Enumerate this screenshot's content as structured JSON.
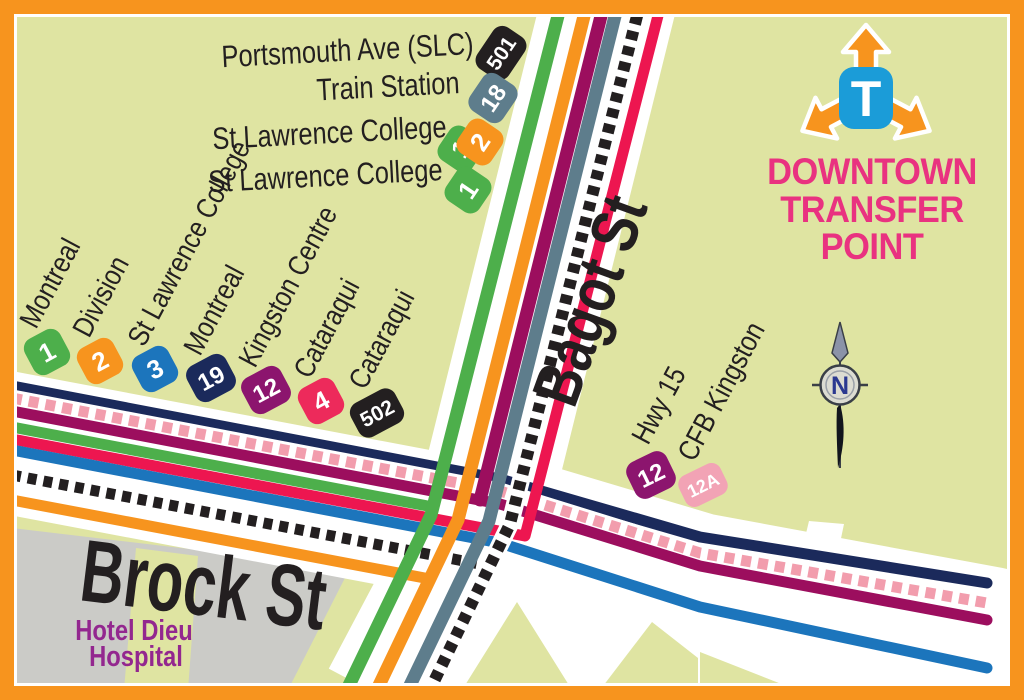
{
  "map_title": {
    "line1": "DOWNTOWN",
    "line2": "TRANSFER",
    "line3": "POINT",
    "logo_letter": "T"
  },
  "streets": {
    "vertical": "Bagot St",
    "horizontal": "Brock St"
  },
  "landmark": {
    "line1": "Hotel Dieu",
    "line2": "Hospital"
  },
  "compass": {
    "north_label": "N"
  },
  "colors": {
    "border": "#F7941E",
    "background": "#DFE4A2",
    "road": "#FFFFFF",
    "block_gray": "#CBCBC7",
    "title_pink": "#E93280",
    "landmark_purple": "#93278F",
    "label_black": "#231F20",
    "logo_blue": "#1B9CD8",
    "logo_orange": "#F7941E",
    "compass_navy": "#2B3990"
  },
  "routes": {
    "r1": {
      "number": "1",
      "color": "#4DAF4B"
    },
    "r2": {
      "number": "2",
      "color": "#F7941E"
    },
    "r3": {
      "number": "3",
      "color": "#1C75BC"
    },
    "r4": {
      "number": "4",
      "color": "#ED1650"
    },
    "r12": {
      "number": "12",
      "color": "#9C0E5E"
    },
    "r12a": {
      "number": "12A",
      "color": "#F29DAD"
    },
    "r18": {
      "number": "18",
      "color": "#5E7D8C"
    },
    "r19": {
      "number": "19",
      "color": "#1B2A5B"
    },
    "r501": {
      "number": "501",
      "color": "#231F20"
    },
    "r502": {
      "number": "502",
      "color": "#231F20"
    }
  },
  "top_stops": [
    {
      "label": "Portsmouth Ave (SLC)",
      "badges": [
        {
          "text": "501",
          "color": "#231F20"
        }
      ]
    },
    {
      "label": "Train Station",
      "badges": [
        {
          "text": "18",
          "color": "#5E7D8C"
        }
      ]
    },
    {
      "label": "St Lawrence College",
      "badges": [
        {
          "text": "1",
          "color": "#4DAF4B"
        },
        {
          "text": "2",
          "color": "#F7941E"
        }
      ]
    },
    {
      "label": "St Lawrence College",
      "badges": [
        {
          "text": "1",
          "color": "#4DAF4B"
        }
      ]
    }
  ],
  "west_stops": [
    {
      "label": "Montreal",
      "badge": {
        "text": "1",
        "color": "#4DAF4B"
      }
    },
    {
      "label": "Division",
      "badge": {
        "text": "2",
        "color": "#F7941E"
      }
    },
    {
      "label": "St Lawrence College",
      "badge": {
        "text": "3",
        "color": "#1C75BC"
      }
    },
    {
      "label": "Montreal",
      "badge": {
        "text": "19",
        "color": "#1B2A5B"
      }
    },
    {
      "label": "Kingston Centre",
      "badge": {
        "text": "12",
        "color": "#8C156E"
      }
    },
    {
      "label": "Cataraqui",
      "badge": {
        "text": "4",
        "color": "#ED2A5B"
      }
    },
    {
      "label": "Cataraqui",
      "badge": {
        "text": "502",
        "color": "#231F20"
      }
    }
  ],
  "east_stops": [
    {
      "label": "Hwy 15",
      "badge": {
        "text": "12",
        "color": "#8C156E"
      }
    },
    {
      "label": "CFB Kingston",
      "badge": {
        "text": "12A",
        "color": "#F2A3B5"
      }
    }
  ]
}
